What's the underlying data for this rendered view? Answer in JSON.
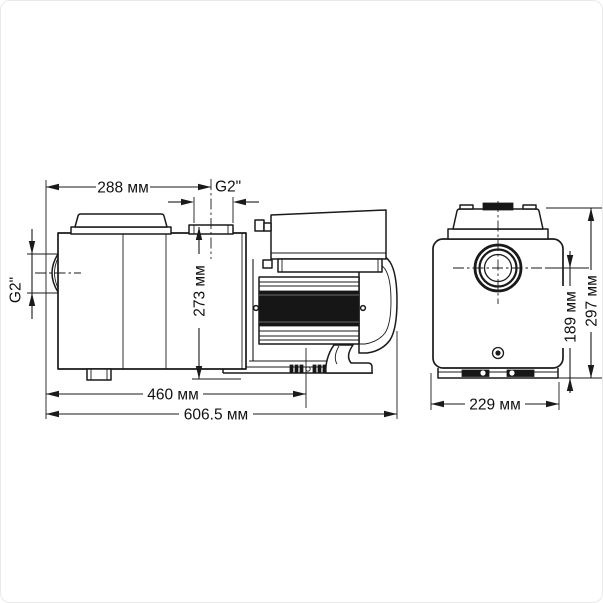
{
  "page": {
    "background_color": "#ffffff",
    "border_color": "#e9e9e9",
    "line_color": "#1a1a1a"
  },
  "drawing": {
    "type": "technical-dimensional-drawing",
    "subject": "swimming-pool pump, two orthographic views with dimensions",
    "unit": "мм",
    "side_view": {
      "dim_width_upper": "288 мм",
      "outlet_thread": "G2\"",
      "inlet_thread": "G2\"",
      "dim_height": "273 мм",
      "dim_mount_length": "460 мм",
      "dim_overall_length": "606.5 мм"
    },
    "front_view": {
      "dim_overall_height": "297 мм",
      "dim_port_center_height": "189 мм",
      "dim_overall_width": "229 мм"
    }
  }
}
